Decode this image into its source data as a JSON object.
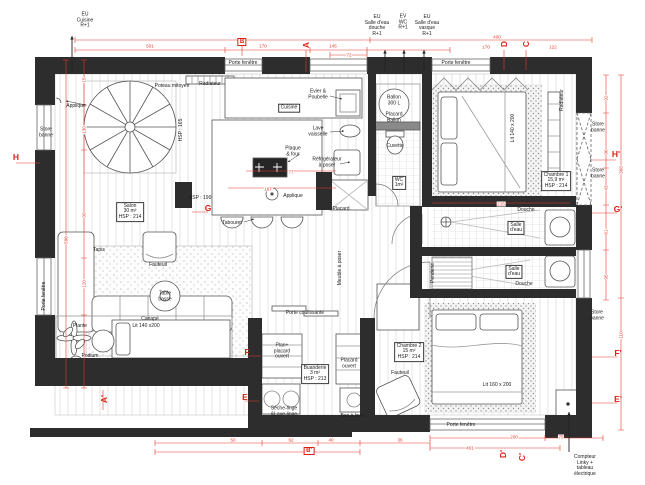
{
  "title": "Plan d'appartement coté",
  "colors": {
    "dim_red": "#e8392b",
    "wall_dark": "#2d2d2d",
    "paper": "#ffffff"
  },
  "labels": [
    {
      "n": "riser-eu-cuisine",
      "t": "EU\nCuisine\nR+1",
      "x": 85,
      "y": 21
    },
    {
      "n": "riser-eu-salle-eau-douche",
      "t": "EU\nSalle d'eau\ndouche\nR+1",
      "x": 377,
      "y": 26
    },
    {
      "n": "riser-ev-wc",
      "t": "EV\nWC\nR+1",
      "x": 403,
      "y": 23
    },
    {
      "n": "riser-eu-salle-eau-vasque",
      "t": "EU\nSalle d'eau\nvasque\nR+1",
      "x": 427,
      "y": 26
    },
    {
      "n": "porte-fenetre-top-left",
      "t": "Porte fenêtre",
      "x": 243,
      "y": 64
    },
    {
      "n": "radiateur-top",
      "t": "Radiateur",
      "x": 210,
      "y": 85
    },
    {
      "n": "poteau-mitoyen",
      "t": "Poteau mitoyen",
      "x": 172,
      "y": 87
    },
    {
      "n": "applique-salon",
      "t": "Applique",
      "x": 76,
      "y": 107
    },
    {
      "n": "hsp-165",
      "t": "HSP : 165",
      "x": 182,
      "y": 130,
      "r": 1
    },
    {
      "n": "store-banne-left",
      "t": "Store\nbanne",
      "x": 46,
      "y": 133
    },
    {
      "n": "porte-fenetre-left",
      "t": "Porte fenêtre",
      "x": 45,
      "y": 296,
      "r": 1
    },
    {
      "n": "salon",
      "t": "Salon\n30 m²\nHSP : 214",
      "x": 130,
      "y": 212,
      "c": 1
    },
    {
      "n": "tapis",
      "t": "Tapis",
      "x": 99,
      "y": 251
    },
    {
      "n": "fauteuil-salon",
      "t": "Fauteuil",
      "x": 158,
      "y": 266
    },
    {
      "n": "table-basse",
      "t": "Table\nbasse",
      "x": 165,
      "y": 297
    },
    {
      "n": "canape",
      "t": "Canapé",
      "x": 150,
      "y": 320
    },
    {
      "n": "plante",
      "t": "Plante",
      "x": 80,
      "y": 327
    },
    {
      "n": "podium",
      "t": "Podium",
      "x": 90,
      "y": 357
    },
    {
      "n": "lit-salon",
      "t": "Lit 140 x200",
      "x": 146,
      "y": 327
    },
    {
      "n": "cuisine",
      "t": "Cuisine",
      "x": 289,
      "y": 108,
      "c": 1
    },
    {
      "n": "evier-poubelle",
      "t": "Evier &\nPoubelle",
      "x": 318,
      "y": 95
    },
    {
      "n": "lave-vaisselle",
      "t": "Lave\nvaisselle",
      "x": 318,
      "y": 132
    },
    {
      "n": "plaque-four",
      "t": "Plaque\n& four",
      "x": 293,
      "y": 152
    },
    {
      "n": "refrigerateur",
      "t": "Réfrigérateur\nà poser",
      "x": 327,
      "y": 163
    },
    {
      "n": "applique-cuisine",
      "t": "Applique",
      "x": 293,
      "y": 197
    },
    {
      "n": "tabouret",
      "t": "Tabouret",
      "x": 232,
      "y": 224
    },
    {
      "n": "placard-hall",
      "t": "Placard",
      "x": 341,
      "y": 210
    },
    {
      "n": "hsp-190",
      "t": "HSP : 190",
      "x": 200,
      "y": 199
    },
    {
      "n": "ballon-300l",
      "t": "Ballon\n300 L",
      "x": 394,
      "y": 101
    },
    {
      "n": "placard-ballon",
      "t": "Placard\nBallon",
      "x": 394,
      "y": 118
    },
    {
      "n": "cuvette",
      "t": "Cuvette",
      "x": 395,
      "y": 147
    },
    {
      "n": "wc",
      "t": "WC\n1m²",
      "x": 399,
      "y": 183,
      "c": 1
    },
    {
      "n": "meuble-a-poser",
      "t": "Meuble à poser",
      "x": 341,
      "y": 268,
      "r": 1
    },
    {
      "n": "porte-coulissante",
      "t": "Porte coulissante",
      "x": 305,
      "y": 314
    },
    {
      "n": "penderie",
      "t": "Penderie",
      "x": 434,
      "y": 273,
      "r": 1
    },
    {
      "n": "salle-eau-1",
      "t": "Salle\nd'eau",
      "x": 516,
      "y": 228,
      "c": 1
    },
    {
      "n": "douche-1",
      "t": "Douche",
      "x": 526,
      "y": 211
    },
    {
      "n": "salle-eau-2",
      "t": "Salle\nd'eau",
      "x": 514,
      "y": 272,
      "c": 1
    },
    {
      "n": "douche-2",
      "t": "Douche",
      "x": 524,
      "y": 285
    },
    {
      "n": "chambre-1",
      "t": "Chambre 1\n15,9 m²\nHSP : 214",
      "x": 556,
      "y": 181,
      "c": 1
    },
    {
      "n": "lit-chambre-1",
      "t": "Lit 140 x 200",
      "x": 514,
      "y": 128,
      "r": 1
    },
    {
      "n": "radiateur-chambre-1",
      "t": "Radiateur",
      "x": 563,
      "y": 100,
      "r": 1
    },
    {
      "n": "porte-fenetre-top-right",
      "t": "Porte fenêtre",
      "x": 456,
      "y": 64
    },
    {
      "n": "store-banne-right-1",
      "t": "Store\nbanne",
      "x": 598,
      "y": 128
    },
    {
      "n": "store-banne-right-2",
      "t": "Store\nbanne",
      "x": 598,
      "y": 174
    },
    {
      "n": "store-banne-right-3",
      "t": "Store\nbanne",
      "x": 597,
      "y": 316
    },
    {
      "n": "chambre-2",
      "t": "Chambre 2\n15 m²\nHSP : 214",
      "x": 409,
      "y": 352,
      "c": 1
    },
    {
      "n": "fauteuil-chambre-2",
      "t": "Fauteuil",
      "x": 400,
      "y": 374
    },
    {
      "n": "lit-chambre-2",
      "t": "Lit 160 x 200",
      "x": 497,
      "y": 386
    },
    {
      "n": "plan-placard-ouvert",
      "t": "Plan+\nplacard\nouvert",
      "x": 282,
      "y": 352
    },
    {
      "n": "buanderie",
      "t": "Buanderie\n3 m²\nHSP : 213",
      "x": 315,
      "y": 374,
      "c": 1
    },
    {
      "n": "placard-ouvert",
      "t": "Placard\nouvert",
      "x": 349,
      "y": 364
    },
    {
      "n": "seche-linge-lave-linge",
      "t": "Sèche-linge\n&Lave-linge",
      "x": 284,
      "y": 412
    },
    {
      "n": "bac-a-laver",
      "t": "Bac à laver",
      "x": 353,
      "y": 417
    },
    {
      "n": "porte-fenetre-bottom",
      "t": "Porte fenêtre",
      "x": 461,
      "y": 426
    },
    {
      "n": "compteur-linky",
      "t": "Compteur\nLinky +\ntableau\nélectrique",
      "x": 585,
      "y": 466
    }
  ],
  "markers": [
    {
      "n": "section-marker-a",
      "t": "A",
      "x": 306,
      "y": 45,
      "r": 1
    },
    {
      "n": "section-marker-b",
      "t": "B",
      "x": 242,
      "y": 42,
      "c": 1
    },
    {
      "n": "section-marker-d",
      "t": "D",
      "x": 504,
      "y": 44,
      "r": 1
    },
    {
      "n": "section-marker-c",
      "t": "C",
      "x": 526,
      "y": 44,
      "r": 1
    },
    {
      "n": "section-marker-h",
      "t": "H",
      "x": 16,
      "y": 157
    },
    {
      "n": "section-marker-h-prime",
      "t": "H'",
      "x": 616,
      "y": 154
    },
    {
      "n": "section-marker-g",
      "t": "G",
      "x": 208,
      "y": 208
    },
    {
      "n": "section-marker-g-prime",
      "t": "G'",
      "x": 618,
      "y": 209
    },
    {
      "n": "section-marker-f",
      "t": "F",
      "x": 247,
      "y": 352
    },
    {
      "n": "section-marker-e",
      "t": "E",
      "x": 245,
      "y": 397
    },
    {
      "n": "section-marker-f-prime",
      "t": "F'",
      "x": 618,
      "y": 353
    },
    {
      "n": "section-marker-e-prime",
      "t": "E'",
      "x": 618,
      "y": 399
    },
    {
      "n": "section-marker-a-prime",
      "t": "A'",
      "x": 104,
      "y": 399,
      "r": 1
    },
    {
      "n": "section-marker-b-prime",
      "t": "B'",
      "x": 309,
      "y": 451,
      "c": 1
    },
    {
      "n": "section-marker-d-prime",
      "t": "D'",
      "x": 503,
      "y": 454,
      "r": 1
    },
    {
      "n": "section-marker-c-prime",
      "t": "C'",
      "x": 522,
      "y": 457,
      "r": 1
    }
  ],
  "dims": [
    {
      "t": "501",
      "x": 150,
      "y": 46
    },
    {
      "t": "170",
      "x": 263,
      "y": 46
    },
    {
      "t": "145",
      "x": 333,
      "y": 46
    },
    {
      "t": "72",
      "x": 349,
      "y": 55
    },
    {
      "t": "400",
      "x": 497,
      "y": 37
    },
    {
      "t": "170",
      "x": 486,
      "y": 47
    },
    {
      "t": "122",
      "x": 553,
      "y": 47
    },
    {
      "t": "15",
      "x": 84,
      "y": 80,
      "r": 1
    },
    {
      "t": "130",
      "x": 84,
      "y": 130,
      "r": 1
    },
    {
      "t": "90",
      "x": 84,
      "y": 215,
      "r": 1
    },
    {
      "t": "120",
      "x": 84,
      "y": 284,
      "r": 1
    },
    {
      "t": "596",
      "x": 66,
      "y": 240,
      "r": 1
    },
    {
      "t": "92",
      "x": 606,
      "y": 98,
      "r": 1
    },
    {
      "t": "96",
      "x": 606,
      "y": 152,
      "r": 1
    },
    {
      "t": "43",
      "x": 606,
      "y": 188,
      "r": 1
    },
    {
      "t": "61",
      "x": 606,
      "y": 232,
      "r": 1
    },
    {
      "t": "95",
      "x": 606,
      "y": 277,
      "r": 1
    },
    {
      "t": "368",
      "x": 621,
      "y": 170,
      "r": 1
    },
    {
      "t": "110",
      "x": 621,
      "y": 335,
      "r": 1
    },
    {
      "t": "50",
      "x": 233,
      "y": 440
    },
    {
      "t": "62",
      "x": 291,
      "y": 440
    },
    {
      "t": "40",
      "x": 331,
      "y": 440
    },
    {
      "t": "36",
      "x": 400,
      "y": 440
    },
    {
      "t": "200",
      "x": 514,
      "y": 437
    },
    {
      "t": "75",
      "x": 561,
      "y": 437
    },
    {
      "t": "401",
      "x": 470,
      "y": 448
    },
    {
      "t": "77",
      "x": 291,
      "y": 172
    },
    {
      "t": "167",
      "x": 268,
      "y": 189
    },
    {
      "t": "215",
      "x": 501,
      "y": 204
    }
  ]
}
